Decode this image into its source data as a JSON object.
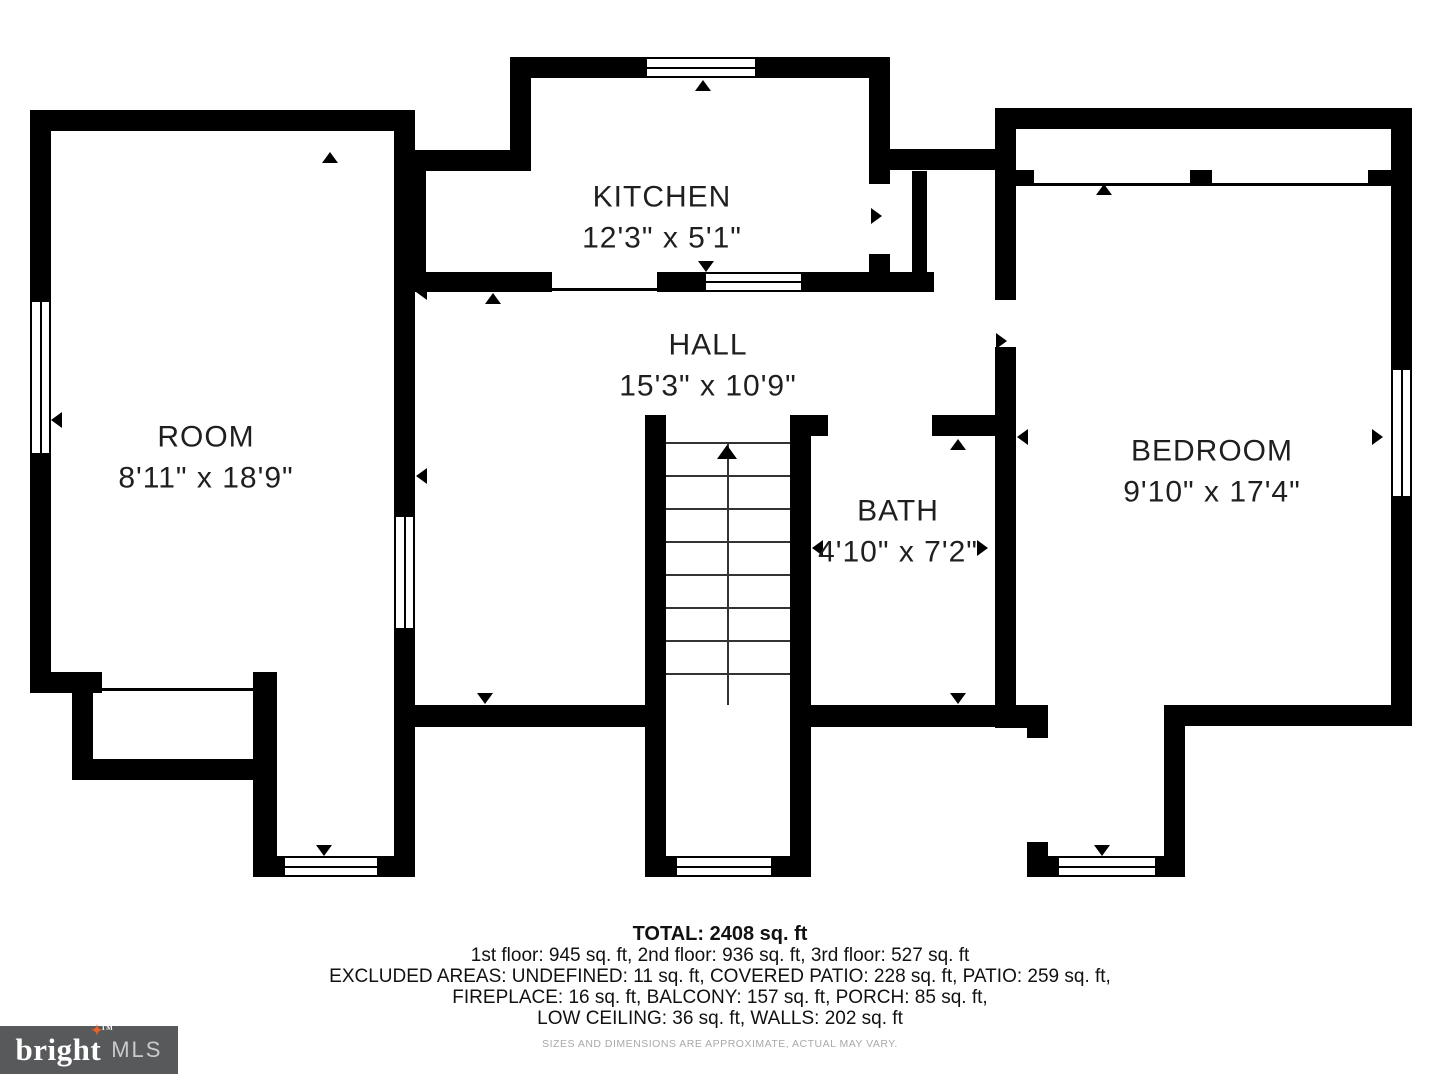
{
  "rooms": [
    {
      "id": "kitchen",
      "name": "KITCHEN",
      "dims": "12'3\" x 5'1\"",
      "cx": 662,
      "cy": 218
    },
    {
      "id": "hall",
      "name": "HALL",
      "dims": "15'3\" x 10'9\"",
      "cx": 708,
      "cy": 366
    },
    {
      "id": "room",
      "name": "ROOM",
      "dims": "8'11\" x 18'9\"",
      "cx": 206,
      "cy": 458
    },
    {
      "id": "bath",
      "name": "BATH",
      "dims": "4'10\" x 7'2\"",
      "cx": 898,
      "cy": 532
    },
    {
      "id": "bedroom",
      "name": "BEDROOM",
      "dims": "9'10\" x 17'4\"",
      "cx": 1212,
      "cy": 472
    }
  ],
  "footer": {
    "total": "TOTAL: 2408 sq. ft",
    "floors": "1st floor: 945 sq. ft, 2nd floor: 936 sq. ft, 3rd floor: 527 sq. ft",
    "excluded1": "EXCLUDED AREAS: UNDEFINED: 11 sq. ft, COVERED PATIO: 228 sq. ft, PATIO: 259 sq. ft,",
    "excluded2": "FIREPLACE: 16 sq. ft, BALCONY: 157 sq. ft, PORCH: 85 sq. ft,",
    "excluded3": "LOW CEILING: 36 sq. ft, WALLS: 202 sq. ft",
    "disclaimer": "SIZES AND DIMENSIONS ARE APPROXIMATE, ACTUAL MAY VARY."
  },
  "logo": {
    "brand": "bright",
    "suffix": "MLS",
    "tm": "TM",
    "star": "✦",
    "star_color": "#e8622b",
    "bg": "#58595b"
  },
  "colors": {
    "wall": "#000000",
    "label": "#1f1f1f",
    "disclaimer": "#a9a9a9"
  },
  "geometry": {
    "walls": [
      {
        "n": "room-top",
        "x": 30,
        "y": 110,
        "w": 385,
        "h": 21
      },
      {
        "n": "room-left",
        "x": 30,
        "y": 110,
        "w": 21,
        "h": 583
      },
      {
        "n": "room-bottom-step-h",
        "x": 30,
        "y": 672,
        "w": 72,
        "h": 21
      },
      {
        "n": "room-step-v",
        "x": 72,
        "y": 693,
        "w": 21,
        "h": 87
      },
      {
        "n": "balcony-bottom",
        "x": 72,
        "y": 759,
        "w": 205,
        "h": 21
      },
      {
        "n": "balcony-right",
        "x": 253,
        "y": 672,
        "w": 24,
        "h": 205
      },
      {
        "n": "room-right-upper",
        "x": 394,
        "y": 110,
        "w": 21,
        "h": 405
      },
      {
        "n": "room-right-lower",
        "x": 394,
        "y": 630,
        "w": 21,
        "h": 247
      },
      {
        "n": "porch-left-bottom",
        "x": 253,
        "y": 856,
        "w": 162,
        "h": 21
      },
      {
        "n": "kitchen-top",
        "x": 510,
        "y": 57,
        "w": 380,
        "h": 21
      },
      {
        "n": "kitchen-left-upper",
        "x": 510,
        "y": 57,
        "w": 21,
        "h": 114
      },
      {
        "n": "kitchen-jog",
        "x": 405,
        "y": 150,
        "w": 126,
        "h": 21
      },
      {
        "n": "kitchen-left-lower",
        "x": 405,
        "y": 150,
        "w": 21,
        "h": 142
      },
      {
        "n": "kitchen-right-upper",
        "x": 869,
        "y": 57,
        "w": 21,
        "h": 114
      },
      {
        "n": "vestibule-top",
        "x": 869,
        "y": 149,
        "w": 147,
        "h": 21
      },
      {
        "n": "kitchen-right-stub-a",
        "x": 869,
        "y": 171,
        "w": 21,
        "h": 13
      },
      {
        "n": "kitchen-right-stub-b",
        "x": 869,
        "y": 254,
        "w": 21,
        "h": 38
      },
      {
        "n": "chimney-wall",
        "x": 912,
        "y": 171,
        "w": 15,
        "h": 105
      },
      {
        "n": "kitchen-bottom-a",
        "x": 405,
        "y": 272,
        "w": 147,
        "h": 20
      },
      {
        "n": "kitchen-bottom-b",
        "x": 657,
        "y": 272,
        "w": 47,
        "h": 20
      },
      {
        "n": "kitchen-bottom-c",
        "x": 803,
        "y": 272,
        "w": 131,
        "h": 20
      },
      {
        "n": "stair-left",
        "x": 645,
        "y": 415,
        "w": 21,
        "h": 462
      },
      {
        "n": "stair-right",
        "x": 790,
        "y": 415,
        "w": 21,
        "h": 462
      },
      {
        "n": "hall-bottom-left",
        "x": 415,
        "y": 705,
        "w": 230,
        "h": 22
      },
      {
        "n": "hall-bottom-right",
        "x": 811,
        "y": 705,
        "w": 205,
        "h": 22
      },
      {
        "n": "bath-top-stub",
        "x": 811,
        "y": 415,
        "w": 17,
        "h": 21
      },
      {
        "n": "bath-top-right",
        "x": 932,
        "y": 415,
        "w": 63,
        "h": 21
      },
      {
        "n": "entry-porch-bottom",
        "x": 666,
        "y": 856,
        "w": 124,
        "h": 21
      },
      {
        "n": "bedroom-left-upper",
        "x": 995,
        "y": 108,
        "w": 21,
        "h": 192
      },
      {
        "n": "bedroom-left-lower",
        "x": 995,
        "y": 347,
        "w": 21,
        "h": 380
      },
      {
        "n": "bedroom-top",
        "x": 995,
        "y": 108,
        "w": 417,
        "h": 21
      },
      {
        "n": "bedroom-right-upper",
        "x": 1391,
        "y": 108,
        "w": 21,
        "h": 260
      },
      {
        "n": "bedroom-right-lower",
        "x": 1391,
        "y": 498,
        "w": 21,
        "h": 228
      },
      {
        "n": "bedroom-bottom",
        "x": 1164,
        "y": 705,
        "w": 248,
        "h": 21
      },
      {
        "n": "right-porch-right",
        "x": 1164,
        "y": 705,
        "w": 21,
        "h": 172
      },
      {
        "n": "bedroom-step-h",
        "x": 995,
        "y": 705,
        "w": 53,
        "h": 23
      },
      {
        "n": "bedroom-step-v",
        "x": 1027,
        "y": 705,
        "w": 21,
        "h": 33
      },
      {
        "n": "right-porch-stub",
        "x": 1027,
        "y": 842,
        "w": 21,
        "h": 35
      },
      {
        "n": "right-porch-bottom",
        "x": 1027,
        "y": 856,
        "w": 158,
        "h": 21
      },
      {
        "n": "lowceil-stub-a",
        "x": 1016,
        "y": 170,
        "w": 18,
        "h": 13
      },
      {
        "n": "lowceil-stub-b",
        "x": 1190,
        "y": 170,
        "w": 22,
        "h": 13
      },
      {
        "n": "lowceil-stub-c",
        "x": 1368,
        "y": 170,
        "w": 23,
        "h": 13
      }
    ],
    "windows": [
      {
        "n": "room-left-window",
        "o": "v",
        "x": 30,
        "y": 300,
        "w": 21,
        "h": 155
      },
      {
        "n": "kitchen-top-window",
        "o": "h",
        "x": 645,
        "y": 57,
        "w": 112,
        "h": 21
      },
      {
        "n": "kitchen-bottom-window",
        "o": "h",
        "x": 704,
        "y": 272,
        "w": 99,
        "h": 20
      },
      {
        "n": "room-interior-window",
        "o": "v",
        "x": 394,
        "y": 515,
        "w": 21,
        "h": 115
      },
      {
        "n": "entry-porch-window",
        "o": "h",
        "x": 675,
        "y": 856,
        "w": 98,
        "h": 21
      },
      {
        "n": "left-porch-window",
        "o": "h",
        "x": 283,
        "y": 856,
        "w": 96,
        "h": 21
      },
      {
        "n": "right-porch-window",
        "o": "h",
        "x": 1057,
        "y": 856,
        "w": 100,
        "h": 21
      },
      {
        "n": "bedroom-right-window",
        "o": "v",
        "x": 1391,
        "y": 368,
        "w": 21,
        "h": 130
      }
    ],
    "thin_lines": [
      {
        "n": "kitchen-open-line",
        "x": 552,
        "y": 288,
        "w": 105,
        "h": 3
      },
      {
        "n": "balcony-open-line",
        "x": 93,
        "y": 688,
        "w": 160,
        "h": 3
      },
      {
        "n": "low-ceiling-line",
        "x": 1016,
        "y": 183,
        "w": 375,
        "h": 3
      }
    ],
    "arrows": [
      {
        "n": "room-top-door-arrow",
        "d": "up",
        "x": 322,
        "y": 152
      },
      {
        "n": "kitchen-top-door-arrow",
        "d": "up",
        "x": 695,
        "y": 80
      },
      {
        "n": "kitchen-bottom-door-arrow",
        "d": "up",
        "x": 485,
        "y": 293
      },
      {
        "n": "kitchen-window-arrow",
        "d": "down",
        "x": 698,
        "y": 261
      },
      {
        "n": "hall-left-upper-arrow",
        "d": "left",
        "x": 416,
        "y": 284
      },
      {
        "n": "hall-left-lower-arrow",
        "d": "left",
        "x": 416,
        "y": 468
      },
      {
        "n": "room-left-window-arrow",
        "d": "left",
        "x": 51,
        "y": 412
      },
      {
        "n": "kitchen-right-door-arrow",
        "d": "right",
        "x": 871,
        "y": 208
      },
      {
        "n": "bedroom-door-arrow",
        "d": "right",
        "x": 996,
        "y": 333
      },
      {
        "n": "bedroom-dims-left-arrow",
        "d": "left",
        "x": 1017,
        "y": 429
      },
      {
        "n": "bedroom-dims-right-arrow",
        "d": "right",
        "x": 1372,
        "y": 429
      },
      {
        "n": "bath-dims-left-arrow",
        "d": "left",
        "x": 812,
        "y": 540
      },
      {
        "n": "bath-dims-right-arrow",
        "d": "right",
        "x": 977,
        "y": 540
      },
      {
        "n": "bath-top-arrow",
        "d": "up",
        "x": 950,
        "y": 439
      },
      {
        "n": "bath-bottom-arrow",
        "d": "down",
        "x": 950,
        "y": 693
      },
      {
        "n": "hall-bottom-arrow",
        "d": "down",
        "x": 477,
        "y": 693
      },
      {
        "n": "left-porch-arrow",
        "d": "down",
        "x": 316,
        "y": 845
      },
      {
        "n": "right-porch-arrow",
        "d": "down",
        "x": 1094,
        "y": 845
      },
      {
        "n": "low-ceiling-arrow",
        "d": "up",
        "x": 1096,
        "y": 184
      }
    ],
    "stairs": {
      "tread_x": 666,
      "tread_w": 124,
      "tread_ys": [
        442,
        475,
        508,
        541,
        574,
        607,
        640,
        673
      ],
      "center_x": 727,
      "center_y1": 442,
      "center_y2": 705,
      "arrowhead": {
        "d": "up",
        "x": 717,
        "y": 445
      }
    }
  }
}
